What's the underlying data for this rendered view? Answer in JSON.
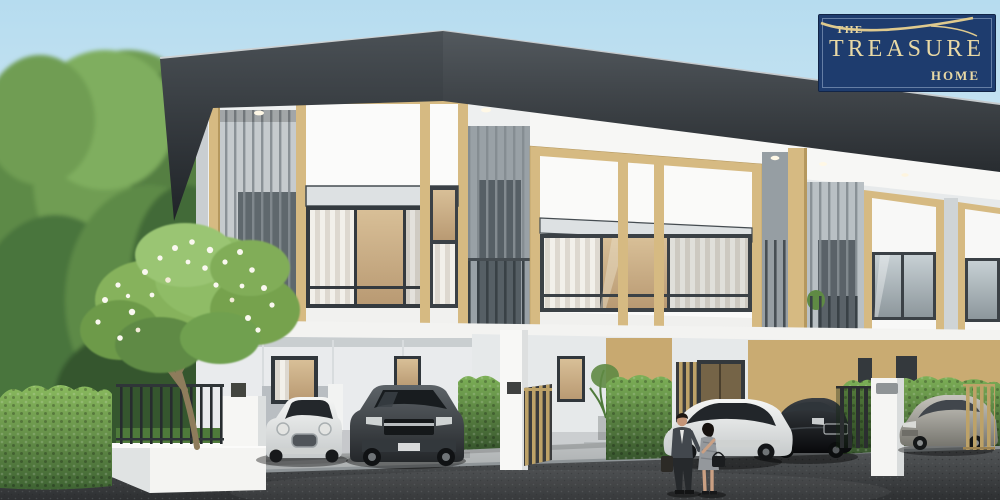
{
  "logo": {
    "the": "THE",
    "treasure": "TREASURE",
    "home": "HOME"
  },
  "palette": {
    "logo_bg": "#1e3c6e",
    "logo_border": "#122547",
    "logo_text": "#e9d9a5",
    "logo_swoosh": "#dfca8e",
    "sky_top": "#b6dcef",
    "sky_bottom": "#eef6fa",
    "roof_dark": "#262b2f",
    "accent_tan": "#d6ba82",
    "wall_white": "#f2f3f2",
    "hedge_green": "#6fa24c",
    "asphalt_gray": "#3f4244"
  }
}
